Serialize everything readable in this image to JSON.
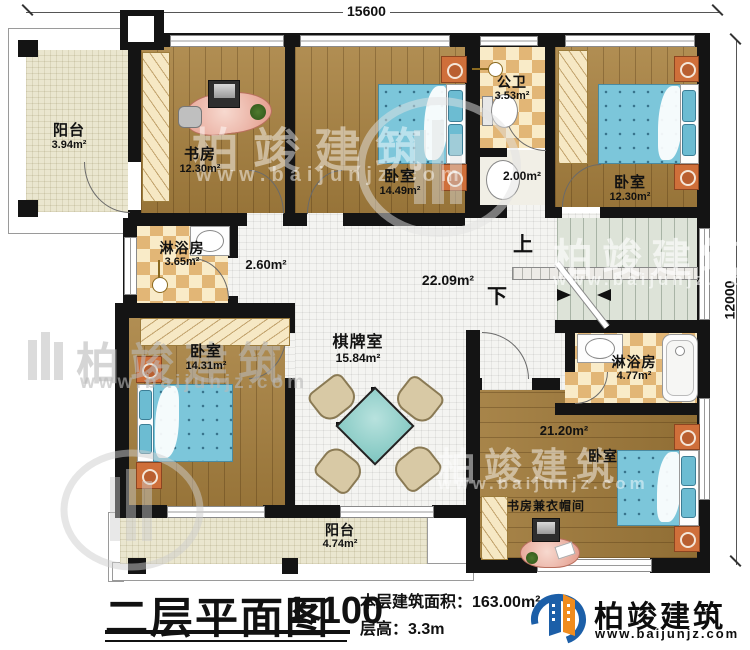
{
  "dimensions": {
    "top": "15600",
    "right": "12000"
  },
  "rooms": {
    "balcony_top": {
      "name": "阳台",
      "area": "3.94m²"
    },
    "study": {
      "name": "书房",
      "area": "12.30m²"
    },
    "bedroom_top": {
      "name": "卧室",
      "area": "14.49m²"
    },
    "public_bath": {
      "name": "公卫",
      "area": "3.53m²"
    },
    "wash": {
      "area": "2.00m²"
    },
    "bedroom_right": {
      "name": "卧室",
      "area": "12.30m²"
    },
    "shower_left": {
      "name": "淋浴房",
      "area": "3.65m²"
    },
    "hall_small": {
      "area": "2.60m²"
    },
    "hall": {
      "area": "22.09m²"
    },
    "bedroom_left": {
      "name": "卧室",
      "area": "14.31m²"
    },
    "game_room": {
      "name": "棋牌室",
      "area": "15.84m²"
    },
    "shower_right": {
      "name": "淋浴房",
      "area": "4.77m²"
    },
    "bedroom_bottom": {
      "name": "卧室",
      "area": "21.20m²"
    },
    "cloakroom": {
      "name": "书房兼衣帽间"
    },
    "balcony_bottom": {
      "name": "阳台",
      "area": "4.74m²"
    }
  },
  "stairs": {
    "up": "上",
    "down": "下"
  },
  "watermark": {
    "brand": "柏竣建筑",
    "url": "www.baijunjz.com"
  },
  "footer": {
    "title": "二层平面图",
    "scale": "1:100",
    "area_line": "本层建筑面积：163.00m²",
    "floor_height_line": "层高：3.3m"
  },
  "logo": {
    "brand": "柏竣建筑",
    "url": "www.baijunjz.com"
  },
  "colors": {
    "wall": "#141414",
    "wood": "#a8813f",
    "checker_tan": "#e2b676",
    "cream_cabinet": "#f6e8c4",
    "tile": "#f4f4f1",
    "stair": "#dde3d8",
    "bed": "#7cc6da",
    "nightstand": "#cf6f3a",
    "table": "#8fd0cb",
    "desk": "#e9a99b",
    "logo_blue": "#1c5fa8",
    "logo_orange": "#f08c1e"
  }
}
